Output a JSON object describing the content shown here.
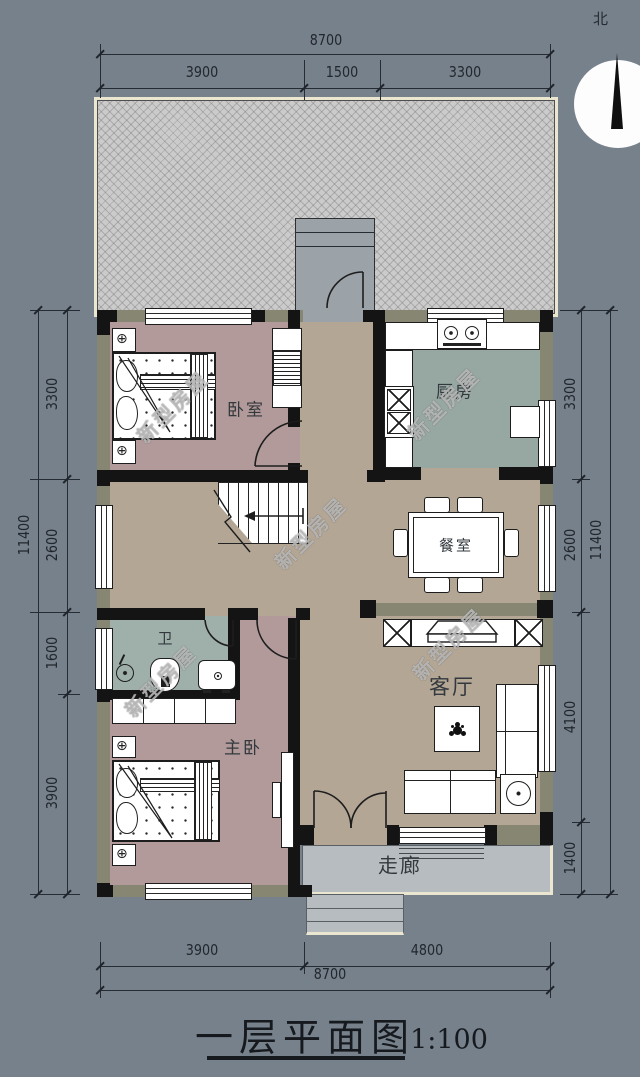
{
  "title": {
    "text": "一层平面图",
    "scale": "1:100"
  },
  "north_label": "北",
  "watermark": "新型房屋",
  "rooms": {
    "bedroom": "卧室",
    "kitchen": "厨房",
    "dining": "餐室",
    "bath": "卫",
    "master": "主卧",
    "living": "客厅",
    "corridor": "走廊"
  },
  "dimensions": {
    "top": {
      "total": "8700",
      "segments": [
        "3900",
        "1500",
        "3300"
      ]
    },
    "bottom": {
      "total": "8700",
      "segments": [
        "3900",
        "4800"
      ]
    },
    "left": {
      "total": "11400",
      "segments": [
        "3300",
        "2600",
        "1600",
        "3900"
      ]
    },
    "right": {
      "total": "11400",
      "segments": [
        "3300",
        "2600",
        "4100",
        "1400"
      ]
    }
  },
  "colors": {
    "background": "#76818C",
    "floor_hall": "#B3A695",
    "floor_bedroom": "#B29A9A",
    "floor_kitchen": "#97A7A2",
    "floor_bath": "#9FB0AB",
    "wall": "#141414",
    "wall_pier": "#878672",
    "yard": "#CBCBCB",
    "trim": "#EAE6CF",
    "porch_slab": "#B7BCC0"
  }
}
